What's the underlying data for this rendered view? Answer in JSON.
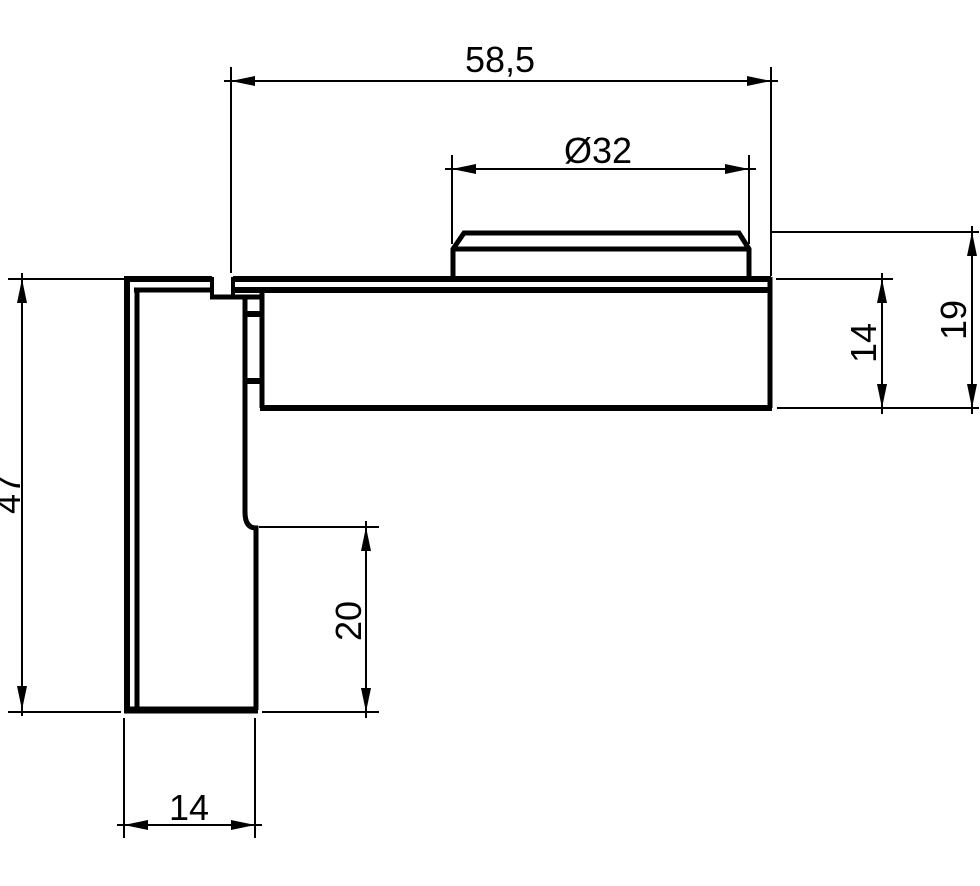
{
  "drawing": {
    "type": "technical-section-drawing",
    "background": "#ffffff",
    "line_color": "#000000",
    "unit": "mm",
    "dimensions": {
      "overall_width": {
        "label": "58,5",
        "value": 58.5,
        "orientation": "horizontal"
      },
      "boss_diameter": {
        "label": "Ø32",
        "value": 32,
        "orientation": "horizontal"
      },
      "arm_total_height": {
        "label": "19",
        "value": 19,
        "orientation": "vertical"
      },
      "arm_plate_thickness": {
        "label": "14",
        "value": 14,
        "orientation": "vertical"
      },
      "leg_height": {
        "label": "47",
        "value": 47,
        "orientation": "vertical"
      },
      "leg_lower_step_height": {
        "label": "20",
        "value": 20,
        "orientation": "vertical"
      },
      "leg_width": {
        "label": "14",
        "value": 14,
        "orientation": "horizontal"
      }
    }
  }
}
